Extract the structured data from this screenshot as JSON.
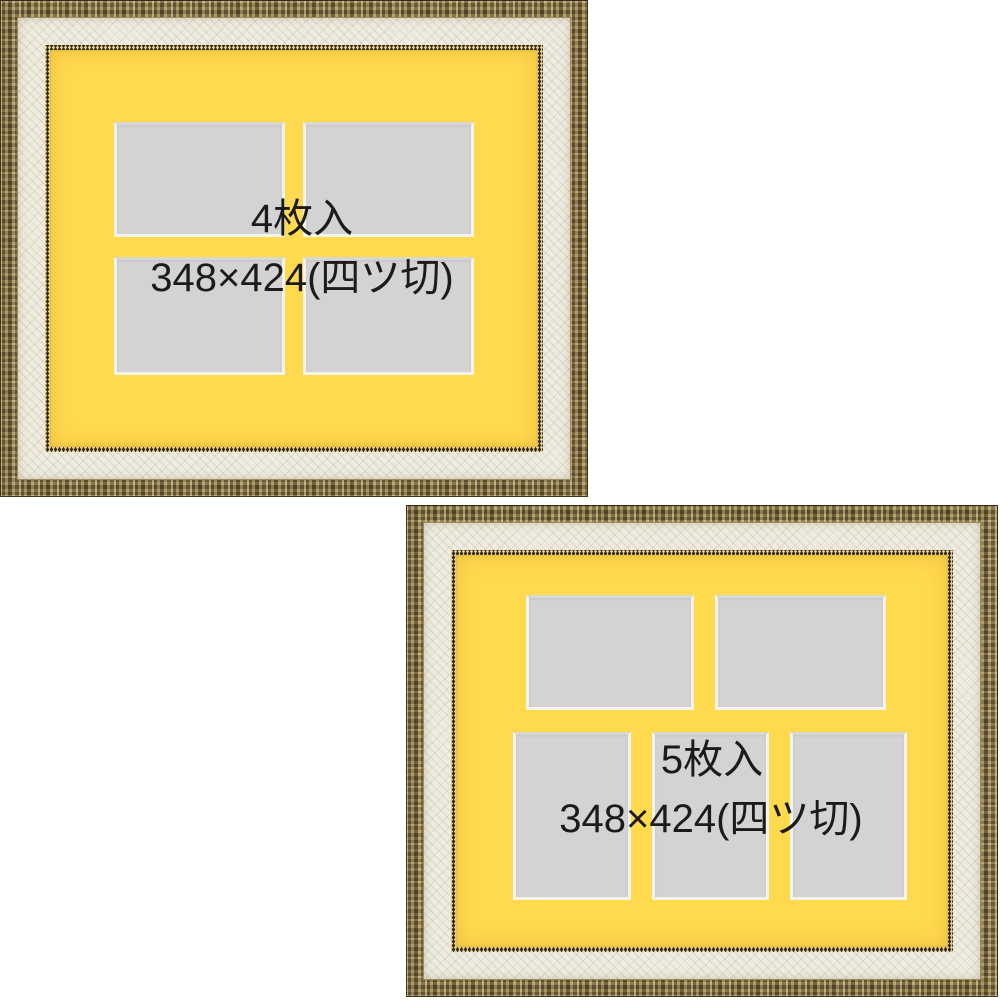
{
  "image_type": "product-photo of two multi-window picture frames",
  "frames": [
    {
      "name": "frame-4-pack",
      "count_label": "4枚入",
      "size_label": "348×424(四ツ切)",
      "openings": 4,
      "opening_layout": "2x2 grid, landscape windows"
    },
    {
      "name": "frame-5-pack",
      "count_label": "5枚入",
      "size_label": "348×424(四ツ切)",
      "openings": 5,
      "opening_layout": "2 landscape windows top row, 3 portrait windows bottom row"
    }
  ],
  "colors": {
    "background": "#FFFFFF",
    "mat_yellow": "#FFD94E",
    "opening_gray": "#D3D3D5",
    "bevel_white": "#F5F4EC",
    "frame_gold": "#8A7A4E",
    "frame_cream": "#EFECDF",
    "bead_gold": "#7A6840",
    "caption_text": "#1B1B1B"
  }
}
